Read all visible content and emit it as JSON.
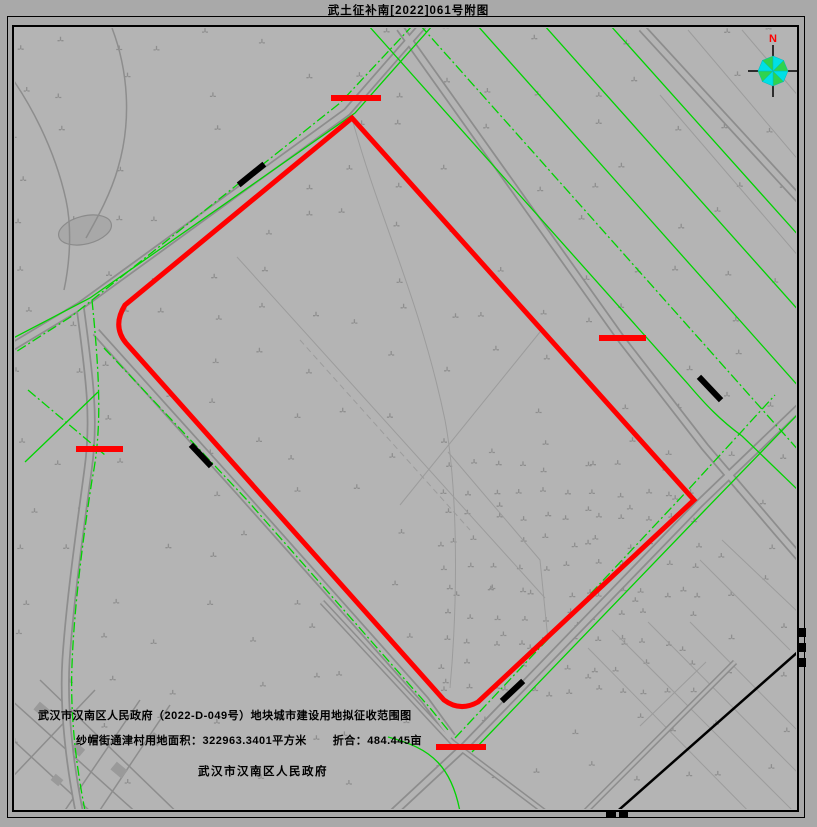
{
  "title": "武土征补南[2022]061号附图",
  "captions": {
    "line1": "武汉市汉南区人民政府（2022-D-049号）地块城市建设用地拟征收范围图",
    "area": "纱帽街通津村用地面积：322963.3401平方米",
    "conversion": "折合：484.445亩",
    "government": "武汉市汉南区人民政府"
  },
  "compass": {
    "north_label": "N"
  },
  "colors": {
    "parcel_boundary_red": "#ff0000",
    "road_edge_green": "#00d400",
    "compass_cyan": "#00e0e6",
    "compass_green": "#2fd34f",
    "map_background": "#b4b4b4",
    "page_background": "#a9a9a9",
    "road_linework_gray": "#8d8d8d",
    "frame_black": "#000000"
  }
}
